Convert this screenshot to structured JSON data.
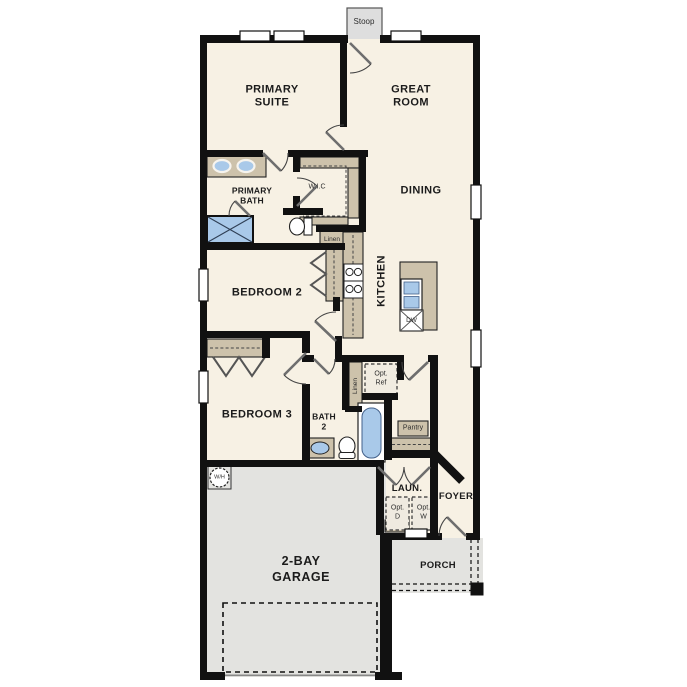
{
  "plan": {
    "type": "residential-floor-plan",
    "labels": {
      "stoop": "Stoop",
      "primary_suite": "PRIMARY\nSUITE",
      "great_room": "GREAT\nROOM",
      "dining": "DINING",
      "primary_bath": "PRIMARY\nBATH",
      "wic": "W.I.C",
      "linen_primary": "Linen",
      "kitchen": "KITCHEN",
      "dishwasher": "DW",
      "bedroom2": "BEDROOM 2",
      "bedroom3": "BEDROOM 3",
      "bath2": "BATH\n2",
      "linen_bath2": "Linen",
      "opt_ref": "Opt.\nRef",
      "pantry": "Pantry",
      "laundry": "LAUN.",
      "opt_dryer": "Opt.\nD",
      "opt_washer": "Opt.\nW",
      "foyer": "FOYER",
      "porch": "PORCH",
      "garage": "2-BAY\nGARAGE",
      "water_heater": "W/H"
    },
    "colors": {
      "wall": "#111111",
      "floor_interior": "#f7f1e4",
      "floor_garage": "#e3e3e0",
      "cabinet_tan": "#cdc2ab",
      "fixture_blue": "#a9c9e9",
      "background": "#ffffff"
    }
  }
}
